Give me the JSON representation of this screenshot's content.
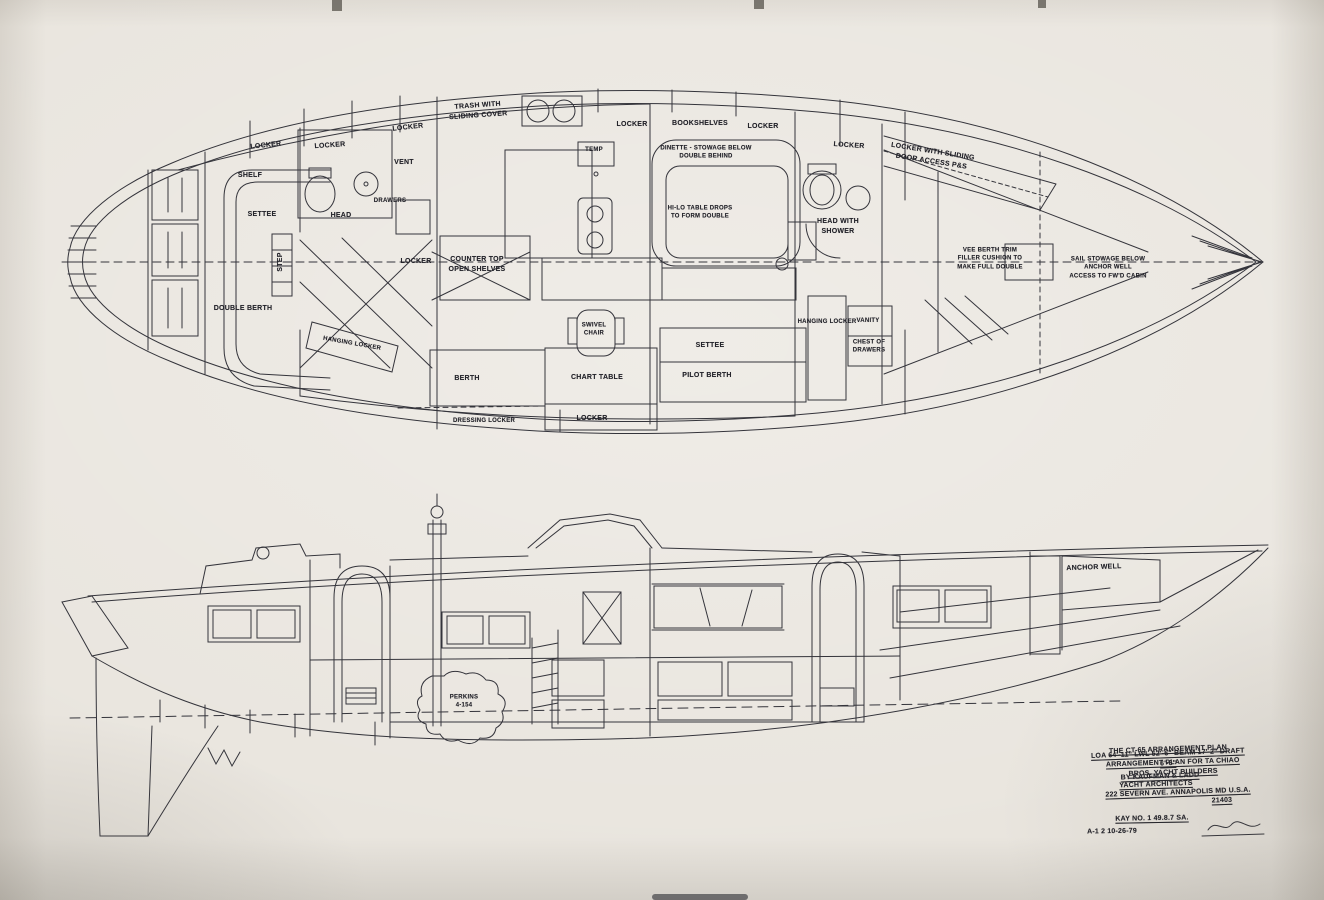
{
  "meta": {
    "description": "Scanned naval-architecture blueprint: CT-65 sailing yacht arrangement plan (deck plan above, profile elevation below)",
    "vessel": "CT-65",
    "paper_color": "#e9e5de",
    "ink_color": "#34343b"
  },
  "plan_view": {
    "name": "arrangement-plan-top-view",
    "labels": [
      {
        "name": "label-locker-aft-1",
        "lines": [
          "LOCKER"
        ],
        "x": 266,
        "y": 146,
        "rot": -6
      },
      {
        "name": "label-locker-aft-2",
        "lines": [
          "LOCKER"
        ],
        "x": 330,
        "y": 146,
        "rot": -4
      },
      {
        "name": "label-locker-aft-3",
        "lines": [
          "LOCKER"
        ],
        "x": 408,
        "y": 128,
        "rot": -6
      },
      {
        "name": "label-vent",
        "lines": [
          "VENT"
        ],
        "x": 404,
        "y": 163
      },
      {
        "name": "label-trash-sliding",
        "lines": [
          "TRASH WITH",
          "SLIDING COVER"
        ],
        "x": 478,
        "y": 111,
        "rot": -4
      },
      {
        "name": "label-locker-galley",
        "lines": [
          "LOCKER"
        ],
        "x": 632,
        "y": 125
      },
      {
        "name": "label-bookshelves",
        "lines": [
          "BOOKSHELVES"
        ],
        "x": 700,
        "y": 124
      },
      {
        "name": "label-locker-saloon",
        "lines": [
          "LOCKER"
        ],
        "x": 763,
        "y": 127
      },
      {
        "name": "label-locker-fwd",
        "lines": [
          "LOCKER"
        ],
        "x": 849,
        "y": 146,
        "rot": 4
      },
      {
        "name": "label-locker-sliding-door",
        "lines": [
          "LOCKER WITH SLIDING",
          "DOOR ACCESS P&S"
        ],
        "x": 932,
        "y": 157,
        "rot": 9
      },
      {
        "name": "label-shelf",
        "lines": [
          "SHELF"
        ],
        "x": 250,
        "y": 176
      },
      {
        "name": "label-settee-aft",
        "lines": [
          "SETTEE"
        ],
        "x": 262,
        "y": 215
      },
      {
        "name": "label-step",
        "lines": [
          "STEP"
        ],
        "x": 281,
        "y": 262,
        "rot": -90
      },
      {
        "name": "label-head-aft",
        "lines": [
          "HEAD"
        ],
        "x": 341,
        "y": 216
      },
      {
        "name": "label-drawers",
        "lines": [
          "DRAWERS"
        ],
        "x": 390,
        "y": 201,
        "cls": "sm"
      },
      {
        "name": "label-locker-mid",
        "lines": [
          "LOCKER"
        ],
        "x": 416,
        "y": 262
      },
      {
        "name": "label-counter-top",
        "lines": [
          "COUNTER TOP",
          "OPEN SHELVES"
        ],
        "x": 477,
        "y": 265
      },
      {
        "name": "label-temp",
        "lines": [
          "TEMP"
        ],
        "x": 594,
        "y": 150,
        "cls": "sm"
      },
      {
        "name": "label-dinette",
        "lines": [
          "DINETTE - STOWAGE BELOW",
          "DOUBLE BEHIND"
        ],
        "x": 706,
        "y": 153,
        "cls": "sm"
      },
      {
        "name": "label-hilo-table",
        "lines": [
          "HI-LO TABLE DROPS",
          "TO FORM DOUBLE"
        ],
        "x": 700,
        "y": 213,
        "cls": "sm"
      },
      {
        "name": "label-head-with-shower",
        "lines": [
          "HEAD WITH",
          "SHOWER"
        ],
        "x": 838,
        "y": 227
      },
      {
        "name": "label-double-berth",
        "lines": [
          "DOUBLE BERTH"
        ],
        "x": 243,
        "y": 309
      },
      {
        "name": "label-hanging-locker-aft",
        "lines": [
          "HANGING LOCKER"
        ],
        "x": 352,
        "y": 344,
        "rot": 10,
        "cls": "sm"
      },
      {
        "name": "label-berth",
        "lines": [
          "BERTH"
        ],
        "x": 467,
        "y": 379
      },
      {
        "name": "label-dressing-locker",
        "lines": [
          "DRESSING LOCKER"
        ],
        "x": 484,
        "y": 421,
        "cls": "sm"
      },
      {
        "name": "label-locker-nav",
        "lines": [
          "LOCKER"
        ],
        "x": 592,
        "y": 419
      },
      {
        "name": "label-chart-table",
        "lines": [
          "CHART TABLE"
        ],
        "x": 597,
        "y": 378
      },
      {
        "name": "label-swivel-chair",
        "lines": [
          "SWIVEL",
          "CHAIR"
        ],
        "x": 594,
        "y": 330,
        "cls": "sm"
      },
      {
        "name": "label-settee-main",
        "lines": [
          "SETTEE"
        ],
        "x": 710,
        "y": 346
      },
      {
        "name": "label-pilot-berth",
        "lines": [
          "PILOT BERTH"
        ],
        "x": 707,
        "y": 376
      },
      {
        "name": "label-hanging-locker-fwd",
        "lines": [
          "HANGING LOCKER"
        ],
        "x": 827,
        "y": 322,
        "cls": "sm"
      },
      {
        "name": "label-vanity",
        "lines": [
          "VANITY"
        ],
        "x": 868,
        "y": 321,
        "cls": "sm"
      },
      {
        "name": "label-chest-of-drawers",
        "lines": [
          "CHEST OF",
          "DRAWERS"
        ],
        "x": 869,
        "y": 347,
        "cls": "sm"
      },
      {
        "name": "label-vee-berth",
        "lines": [
          "VEE BERTH TRIM",
          "FILLER CUSHION TO",
          "MAKE FULL DOUBLE"
        ],
        "x": 990,
        "y": 259,
        "cls": "sm"
      },
      {
        "name": "label-sail-stowage",
        "lines": [
          "SAIL STOWAGE BELOW",
          "ANCHOR WELL",
          "ACCESS TO FW'D CABIN"
        ],
        "x": 1108,
        "y": 268,
        "cls": "sm"
      }
    ]
  },
  "profile_view": {
    "name": "profile-elevation-view",
    "labels": [
      {
        "name": "label-engine",
        "lines": [
          "PERKINS",
          "4-154"
        ],
        "x": 464,
        "y": 702,
        "cls": "sm"
      },
      {
        "name": "label-anchor-well",
        "lines": [
          "ANCHOR WELL"
        ],
        "x": 1094,
        "y": 568,
        "rot": -2
      }
    ]
  },
  "title_block": {
    "labels": [
      {
        "name": "title-line-1",
        "lines": [
          "THE CT-65 ARRANGEMENT PLAN"
        ],
        "x": 1168,
        "y": 750,
        "rot": -2,
        "cls": "tb u"
      },
      {
        "name": "title-line-2",
        "lines": [
          "LOA 64'-11\" LWL 52'-6\" BEAM 17'-2\" DRAFT 6'-6\""
        ],
        "x": 1168,
        "y": 759,
        "rot": -2,
        "cls": "tb u sm"
      },
      {
        "name": "title-line-3",
        "lines": [
          "ARRANGEMENT PLAN FOR TA CHIAO BROS. YACHT BUILDERS"
        ],
        "x": 1173,
        "y": 768,
        "rot": -2,
        "cls": "tb u sm"
      },
      {
        "name": "title-line-4",
        "lines": [
          "BY KAUFMAN & LADD"
        ],
        "x": 1160,
        "y": 777,
        "rot": -2,
        "cls": "tb u"
      },
      {
        "name": "title-line-5",
        "lines": [
          "YACHT ARCHITECTS"
        ],
        "x": 1156,
        "y": 785,
        "rot": -2,
        "cls": "tb u"
      },
      {
        "name": "title-line-6",
        "lines": [
          "222 SEVERN AVE. ANNAPOLIS MD U.S.A."
        ],
        "x": 1178,
        "y": 793,
        "rot": -2,
        "cls": "tb u sm"
      },
      {
        "name": "title-line-7",
        "lines": [
          "21403"
        ],
        "x": 1222,
        "y": 801,
        "rot": -2,
        "cls": "tb u"
      },
      {
        "name": "title-row-1",
        "lines": [
          "KAY NO. 1      49.8.7      SA."
        ],
        "x": 1152,
        "y": 819,
        "rot": -1,
        "cls": "tb u"
      },
      {
        "name": "title-row-2",
        "lines": [
          "A-1  2        10-26-79"
        ],
        "x": 1112,
        "y": 832,
        "rot": -1,
        "cls": "tb sm"
      }
    ]
  }
}
